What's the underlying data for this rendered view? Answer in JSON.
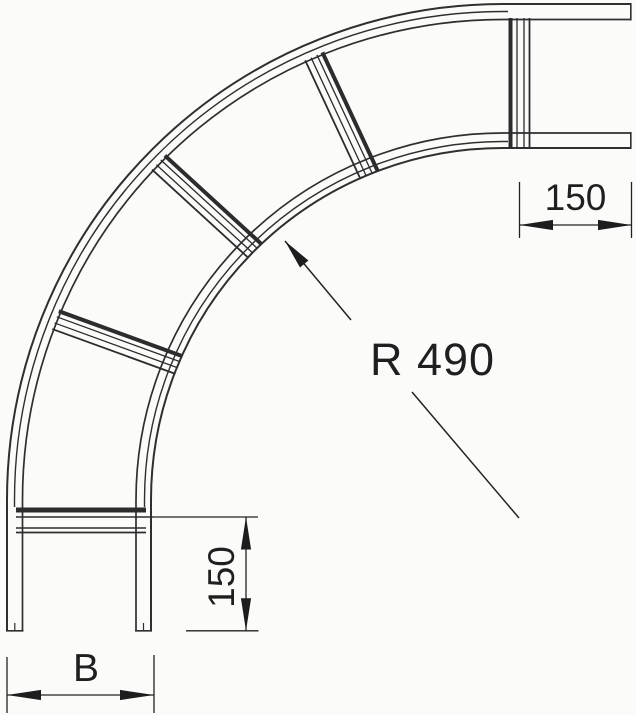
{
  "drawing": {
    "subject": "cable-ladder-90-degree-bend",
    "radius_label": "R 490",
    "dimensions": [
      {
        "id": "end-tangent-top",
        "label": "150",
        "orientation": "horizontal"
      },
      {
        "id": "end-tangent-side",
        "label": "150",
        "orientation": "vertical"
      },
      {
        "id": "width",
        "label": "B",
        "orientation": "horizontal"
      }
    ],
    "colors": {
      "line": "#2f2f2f",
      "dimension": "#232323",
      "text": "#1f1f1f",
      "background": "#fbfbfa"
    }
  }
}
